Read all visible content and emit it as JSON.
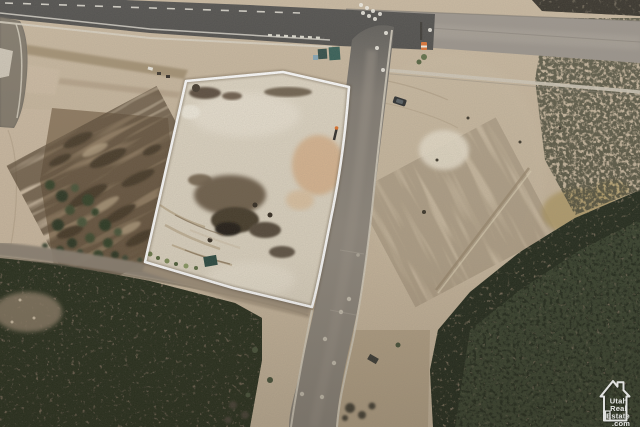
{
  "image": {
    "kind": "aerial-drone-photo",
    "subject": "vacant graded land parcel outlined in white"
  },
  "parcel": {
    "outline_color": "#ffffff"
  },
  "watermark": {
    "logo": "house-icon",
    "color": "#ffffff",
    "lines": [
      "Utah",
      "Real",
      "Estate",
      ".com"
    ]
  },
  "palette": {
    "ground_tan": "#c7b69d",
    "parcel_dirt": "#ddd4c2",
    "asphalt_dark": "#4a4947",
    "asphalt_light": "#99928a",
    "concrete": "#d5cebf",
    "vegetation_dark": "#262d1d",
    "scrub_ground": "#6c6150",
    "rough_brown": "#8d785e",
    "orange_soil": "#d7b28c"
  }
}
